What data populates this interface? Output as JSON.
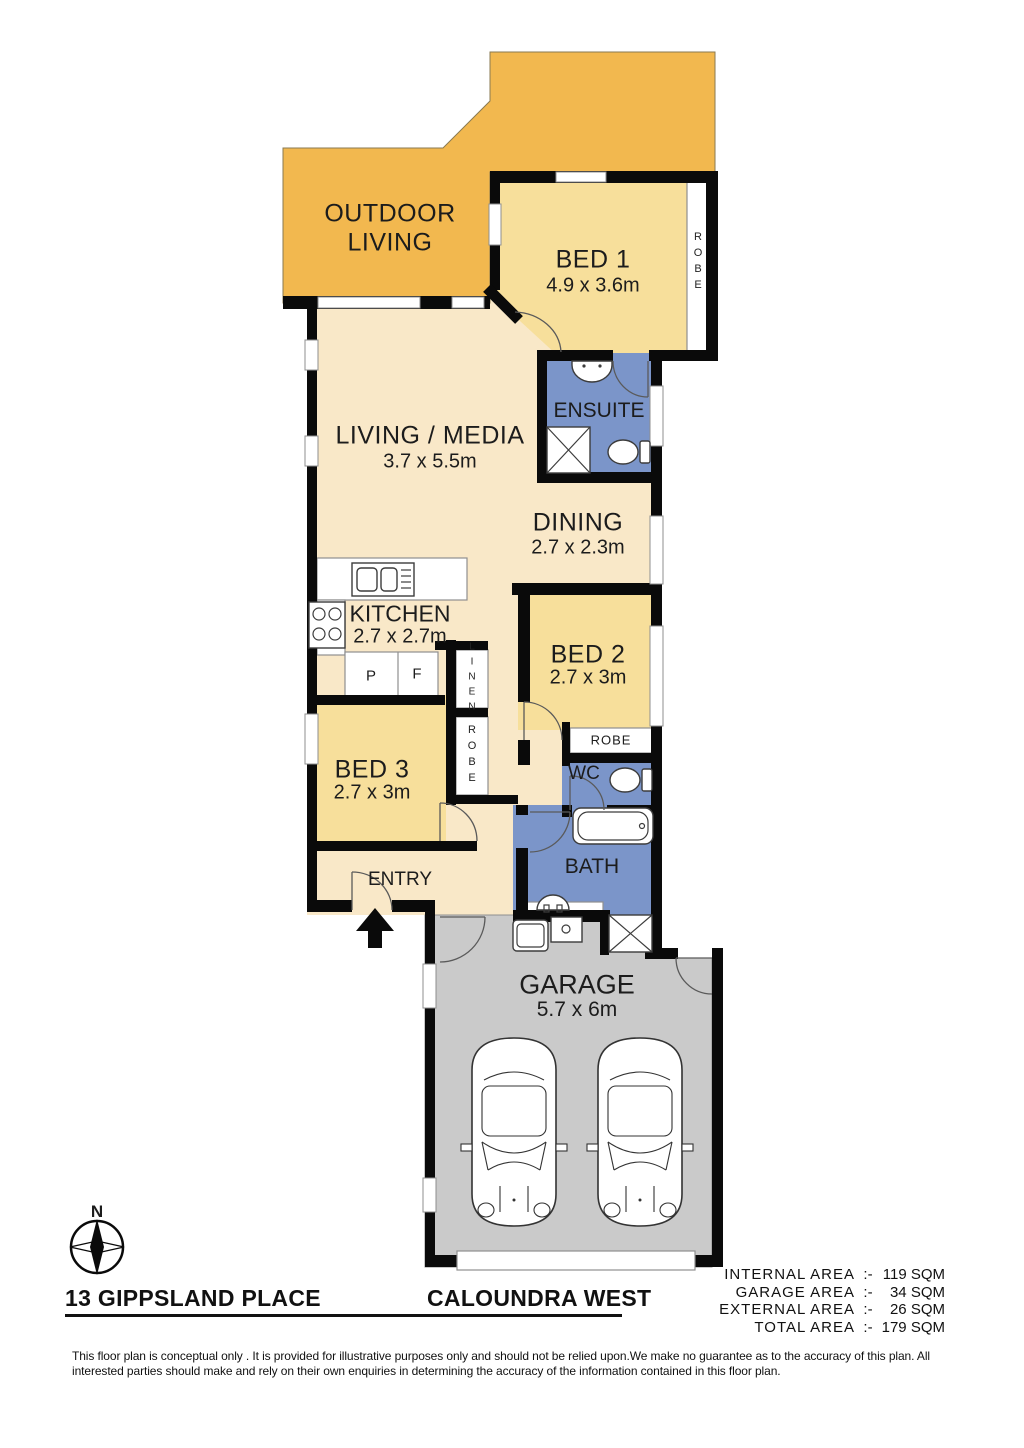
{
  "rooms": {
    "outdoor_living": {
      "name": "OUTDOOR LIVING"
    },
    "bed1": {
      "name": "BED 1",
      "dims": "4.9 x 3.6m"
    },
    "ensuite": {
      "name": "ENSUITE"
    },
    "living": {
      "name": "LIVING / MEDIA",
      "dims": "3.7 x 5.5m"
    },
    "dining": {
      "name": "DINING",
      "dims": "2.7 x 2.3m"
    },
    "kitchen": {
      "name": "KITCHEN",
      "dims": "2.7 x 2.7m"
    },
    "bed2": {
      "name": "BED 2",
      "dims": "2.7 x 3m"
    },
    "bed3": {
      "name": "BED 3",
      "dims": "2.7 x 3m"
    },
    "wc": {
      "name": "WC"
    },
    "bath": {
      "name": "BATH"
    },
    "entry": {
      "name": "ENTRY"
    },
    "garage": {
      "name": "GARAGE",
      "dims": "5.7 x 6m"
    }
  },
  "storage": {
    "robe_bed1": "ROBE",
    "robe_bed2": "ROBE",
    "robe_bed3": "ROBE",
    "linen": "LINEN",
    "pantry": "P",
    "fridge": "F"
  },
  "compass": {
    "north": "N"
  },
  "footer": {
    "address_street": "13 GIPPSLAND PLACE",
    "address_suburb": "CALOUNDRA WEST",
    "areas": {
      "sep": ":-",
      "rows": [
        {
          "label": "INTERNAL  AREA",
          "value": "119 SQM"
        },
        {
          "label": "GARAGE  AREA",
          "value": "34 SQM"
        },
        {
          "label": "EXTERNAL  AREA",
          "value": "26 SQM"
        },
        {
          "label": "TOTAL  AREA",
          "value": "179 SQM"
        }
      ]
    },
    "disclaimer": "This floor plan  is conceptual only . It is provided for illustrative purposes only and should not be relied upon.We make no guarantee as to the accuracy of this plan. All interested parties should make and rely on their own enquiries in determining the accuracy of the information contained in this floor plan."
  },
  "colors": {
    "outdoor": "#F2B84F",
    "bedroom": "#F7DF9B",
    "living": "#F9E8C8",
    "wet": "#7B95C9",
    "garage": "#CACACA",
    "wall": "#0A0A0A"
  }
}
